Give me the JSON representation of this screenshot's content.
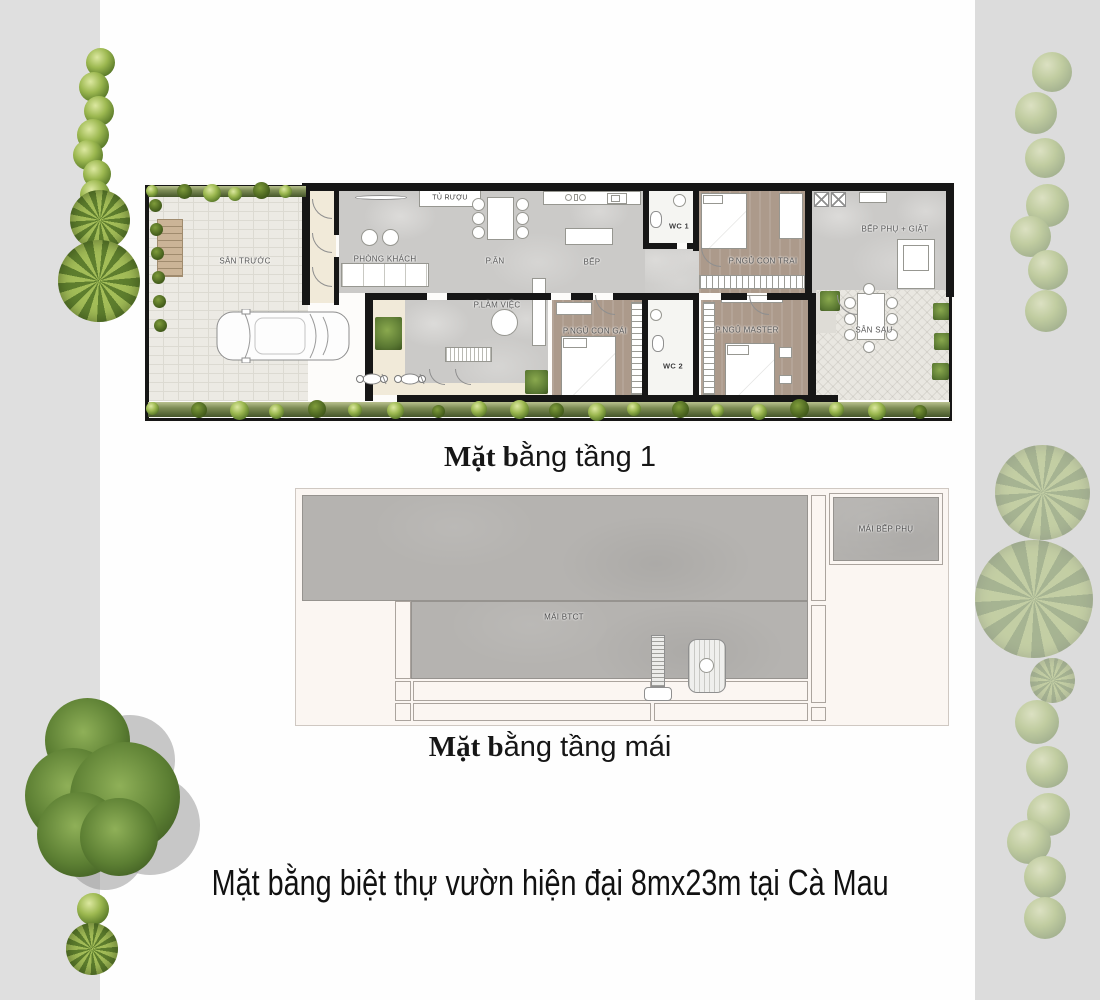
{
  "page": {
    "caption": "Mặt bằng biệt thự vườn hiện đại 8mx23m tại Cà Mau"
  },
  "floor1": {
    "title_bold": "Mặt b",
    "title_rest": "ằng tầng 1",
    "rooms": {
      "san_truoc": "SÂN TRƯỚC",
      "tu_ruou": "TỦ RƯỢU",
      "phong_khach": "PHÒNG KHÁCH",
      "p_an": "P.ĂN",
      "bep": "BẾP",
      "p_lam_viec": "P.LÀM VIỆC",
      "wc1": "WC 1",
      "p_ngu_con_trai": "P.NGỦ CON TRAI",
      "bep_phu_giat": "BẾP PHỤ + GIẶT",
      "p_ngu_con_gai": "P.NGỦ CON GÁI",
      "wc2": "WC 2",
      "p_ngu_master": "P.NGỦ MASTER",
      "san_sau": "SÂN SAU"
    }
  },
  "roof": {
    "title_bold": "Mặt b",
    "title_rest": "ằng tầng mái",
    "rooms": {
      "mai_btct": "MÁI BTCT",
      "mai_bep_phu": "MÁI BẾP PHỤ"
    }
  },
  "icons": {
    "tree": "bush-icon",
    "hedge": "hedge-bush-icon",
    "car": "car-top-view-icon",
    "motorbike": "motorbike-icon",
    "solar_heater": "solar-heater-icon",
    "water_tank": "water-tank-icon"
  },
  "colors": {
    "wall": "#161616",
    "marble_floor": "#cbcac8",
    "wood_floor": "#ac9a8b",
    "beige_floor": "#f1ead9",
    "paving": "#eceae4",
    "roof_gray": "#b5b3b0",
    "roof_bg": "#fbf6f2",
    "hedge_green": "#45562a",
    "bush_green": "#7f9c3b",
    "side_strip_gray": "#dfdfdf"
  }
}
